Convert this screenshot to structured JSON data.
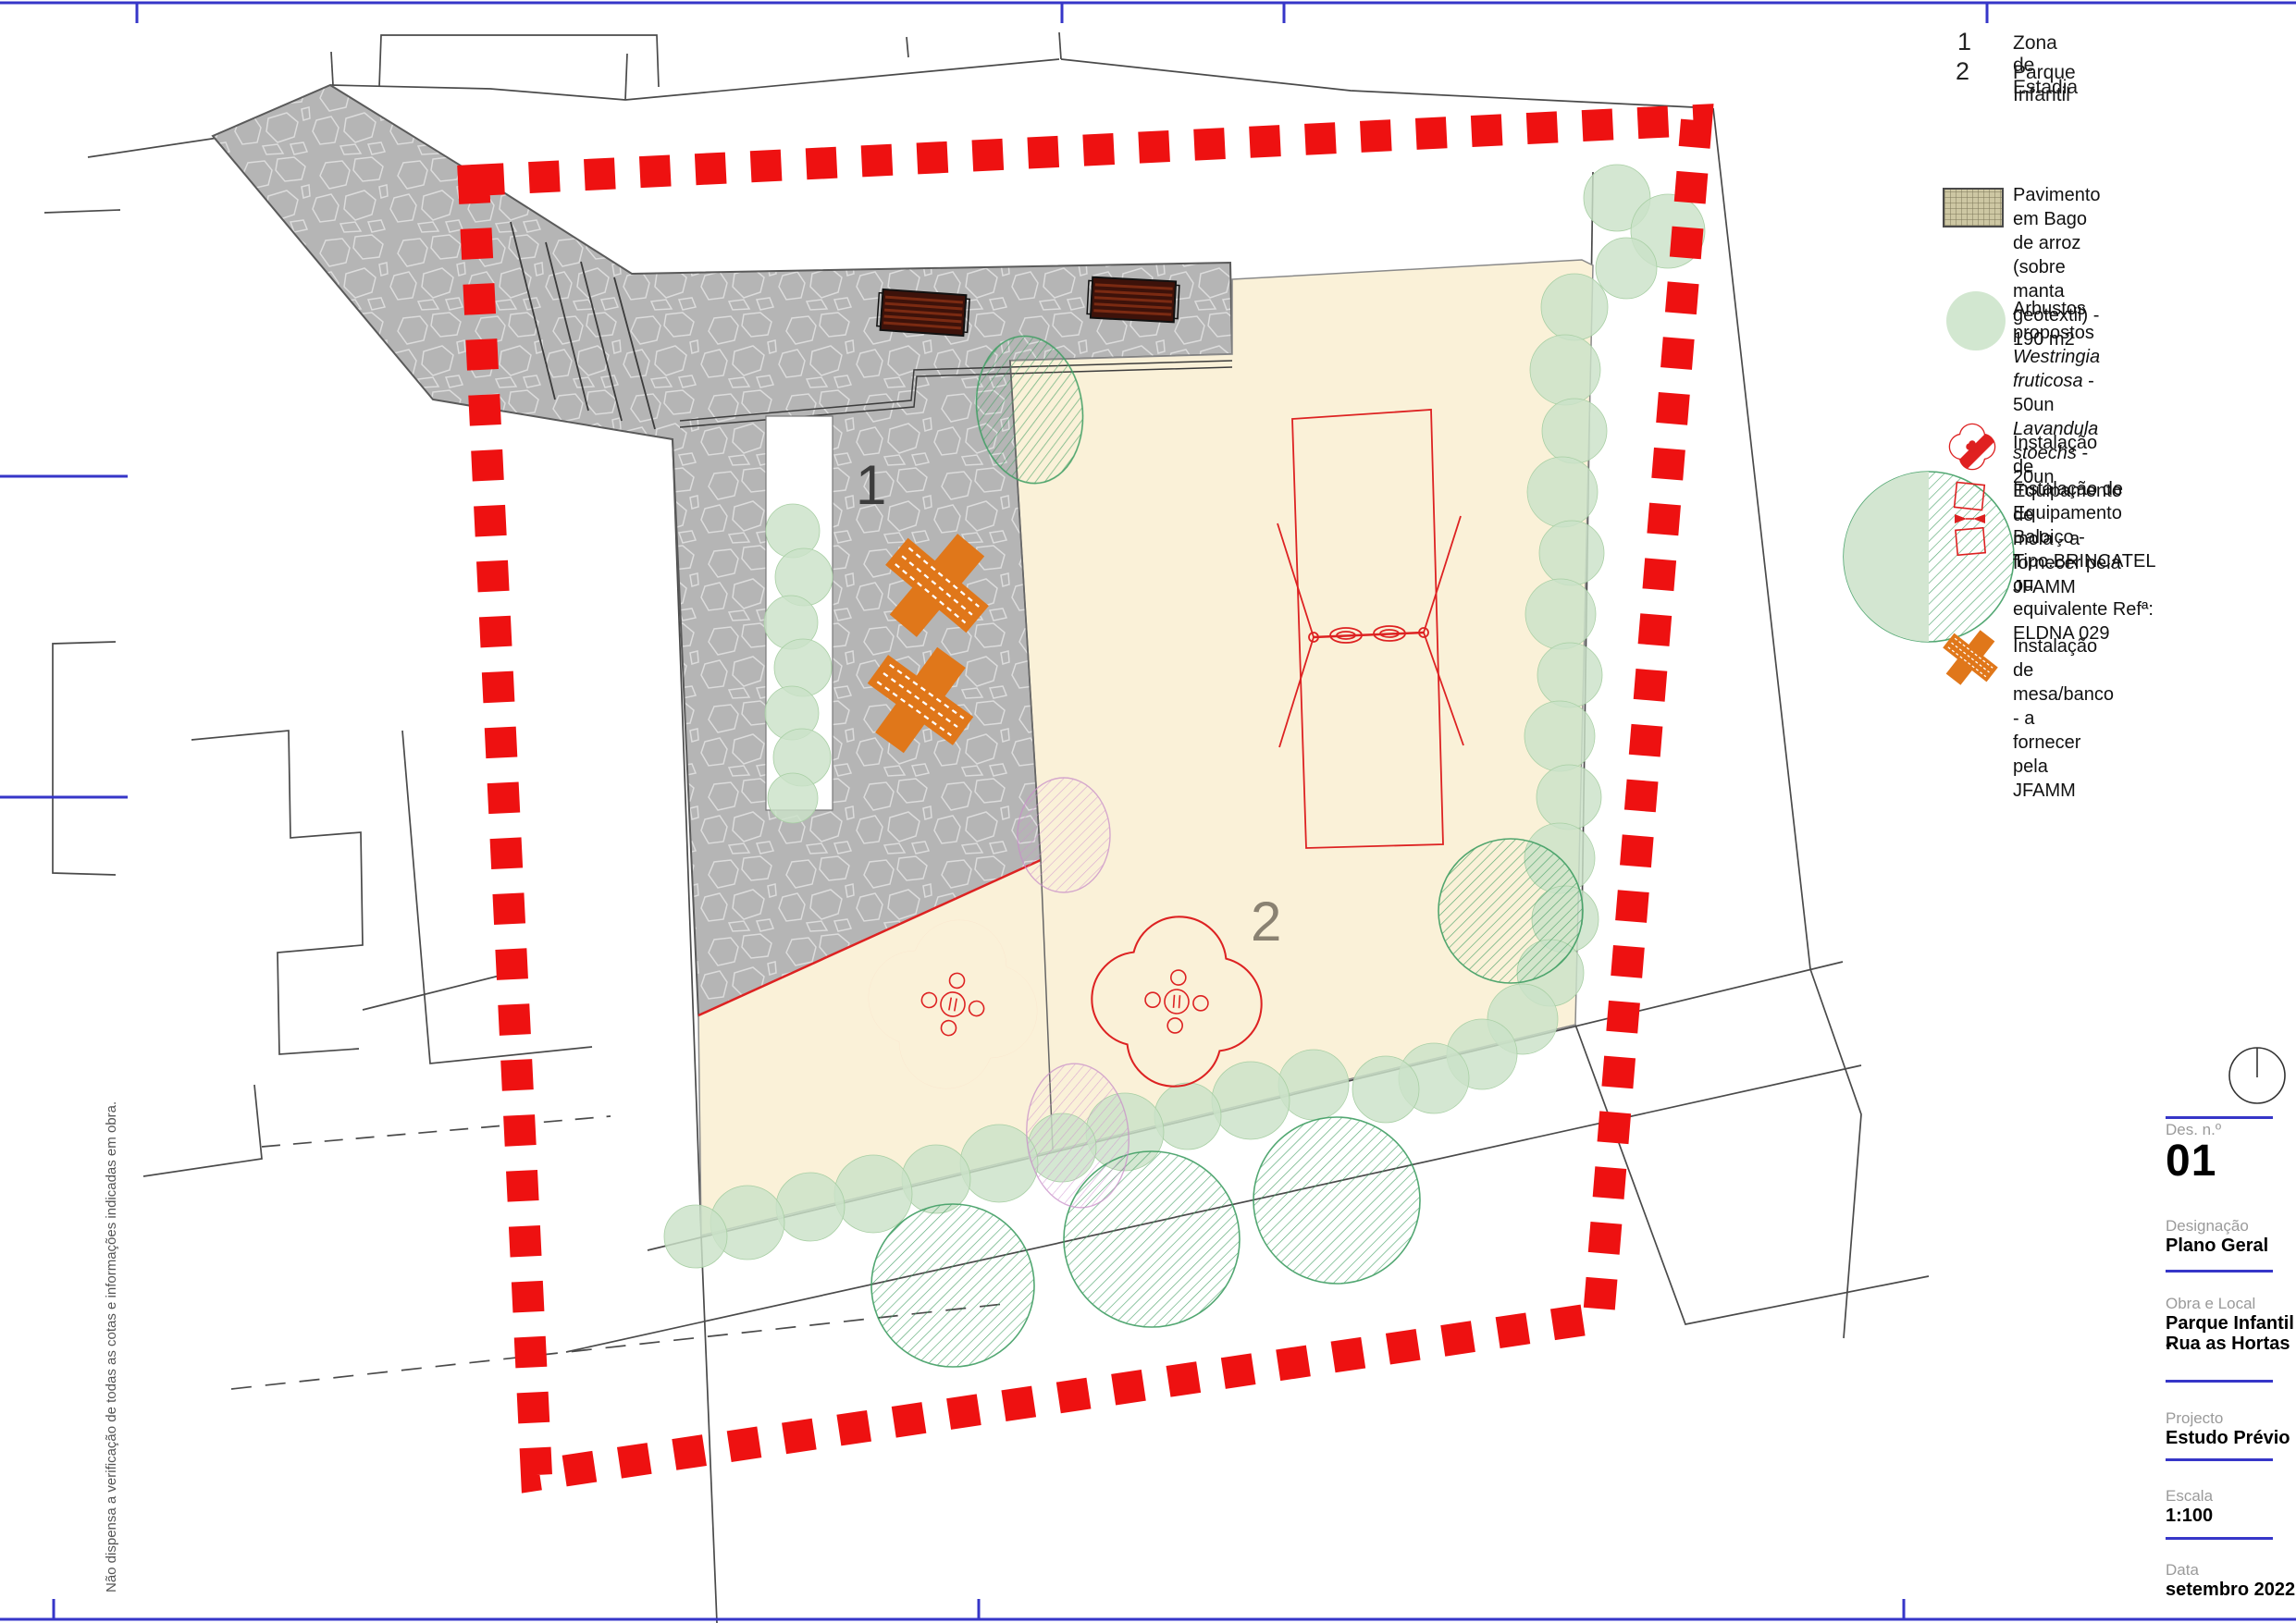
{
  "legend": {
    "zones": [
      {
        "num": "1",
        "label": "Zona de Estadia"
      },
      {
        "num": "2",
        "label": "Parque Infantil"
      }
    ],
    "pavimento": {
      "line1": "Pavimento em Bago de arroz",
      "line2": "(sobre manta geotextil) - 190 m2"
    },
    "arbustos": {
      "title": "Arbustos propostos",
      "sp1": "Westringia fruticosa",
      "sp1_qty": " - 50un",
      "sp2": "Lavandula stoechs",
      "sp2_qty": " - 20un"
    },
    "mola": {
      "line1": "Instalação de Equipamento  de",
      "line2": "mola - a fornecer pela JFAMM"
    },
    "baloico": {
      "line1": "Instalação de Equipamento",
      "line2": "Baloiço - Tipo.BRINCATEL  ou",
      "line3": "equivalente Refª: ELDNA 029"
    },
    "mesa": {
      "line1": "Instalação de mesa/banco - a",
      "line2": "fornecer pela JFAMM"
    }
  },
  "plan": {
    "zone1": "1",
    "zone2": "2"
  },
  "title_block": {
    "des_label": "Des. n.º",
    "des_value": "01",
    "designacao_label": "Designação",
    "designacao_value": "Plano Geral",
    "obra_label": "Obra e Local",
    "obra_line1": "Parque Infantil -",
    "obra_line2": "Rua as Hortas",
    "projecto_label": "Projecto",
    "projecto_value": "Estudo Prévio",
    "escala_label": "Escala",
    "escala_value": "1:100",
    "data_label": "Data",
    "data_value": "setembro 2022"
  },
  "disclaimer": "Não dispensa a verificação de todas as cotas e informações indicadas em obra.",
  "colors": {
    "boundary_red": "#ee1111",
    "paving_gray": "#b5b5b5",
    "sand_cream": "#faf1d8",
    "shrub_green": "#cbe2c8",
    "tree_green": "#3f9e63",
    "equipment_red": "#dd2222",
    "mesa_orange": "#e0771a",
    "frame_blue": "#3636c8",
    "bench_brown": "#3d120a"
  }
}
